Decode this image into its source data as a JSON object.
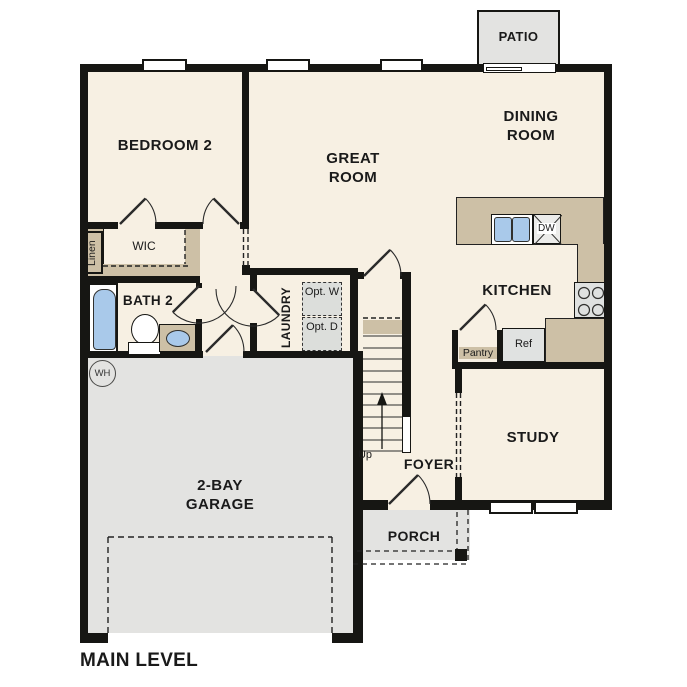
{
  "title": "MAIN LEVEL",
  "rooms": {
    "bedroom2": "BEDROOM 2",
    "great_room": "GREAT ROOM",
    "dining_room": "DINING ROOM",
    "kitchen": "KITCHEN",
    "study": "STUDY",
    "foyer": "FOYER",
    "garage": "2-BAY GARAGE",
    "porch": "PORCH",
    "patio": "PATIO",
    "bath2": "BATH 2",
    "laundry": "LAUNDRY",
    "wic": "WIC",
    "linen": "Linen",
    "pantry": "Pantry"
  },
  "fixtures": {
    "refrigerator": "Ref",
    "dishwasher": "DW",
    "water_heater": "WH",
    "washer_optional": "Opt. W",
    "dryer_optional": "Opt. D",
    "stairs_direction": "Up"
  },
  "colors": {
    "floor": "#f7f0e3",
    "counter_tan": "#cdc0a6",
    "exterior_gray": "#e3e3e1",
    "fixture_blue": "#a9c9ea",
    "wall_black": "#161613"
  }
}
